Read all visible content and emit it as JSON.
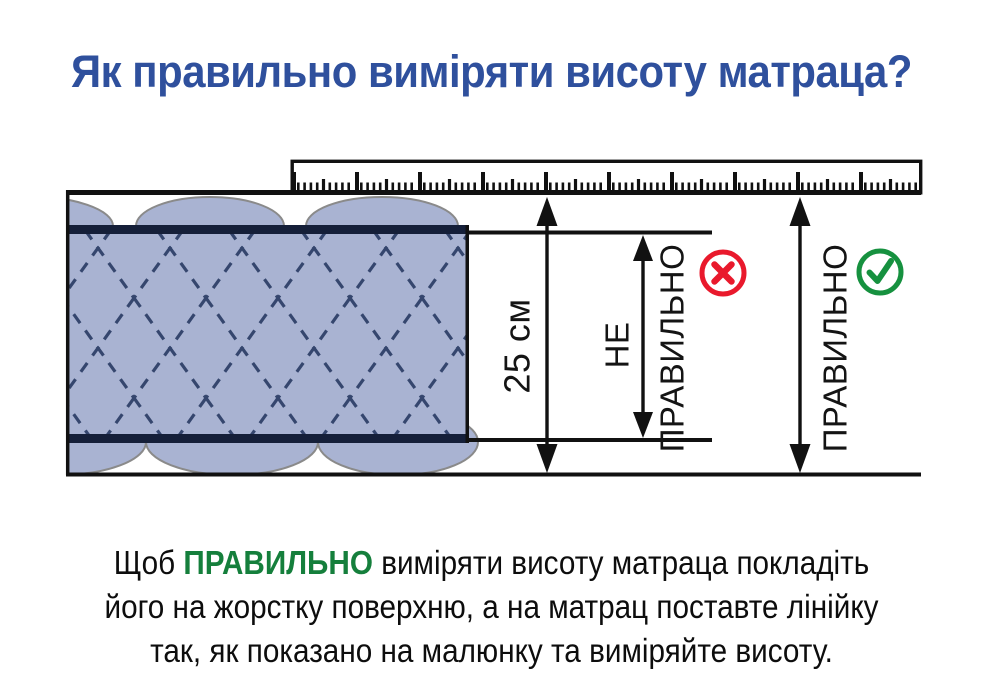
{
  "title": "Як правильно виміряти висоту матраца?",
  "diagram": {
    "measurement_label": "25 см",
    "wrong_label_line1": "НЕ",
    "wrong_label_line2": "ПРАВИЛЬНО",
    "correct_label": "ПРАВИЛЬНО",
    "wrong_icon": "x-in-circle",
    "correct_icon": "check-in-circle"
  },
  "footer": {
    "line1_pre": "Щоб ",
    "line1_highlight": "ПРАВИЛЬНО",
    "line1_post": " виміряти висоту матраца покладіть",
    "line2": "його на жорстку поверхню, а на матрац поставте лінійку",
    "line3": "так, як показано на малюнку та виміряйте висоту."
  },
  "colors": {
    "title": "#2f509d",
    "highlight-green": "#157f3c",
    "icon-green": "#16913f",
    "icon-red": "#e9192c",
    "ink": "#111111",
    "mattress-fill": "#a9b3d2",
    "mattress-band": "#151f39",
    "stitch": "#35466e",
    "bump-outline": "#8a8a8a"
  }
}
